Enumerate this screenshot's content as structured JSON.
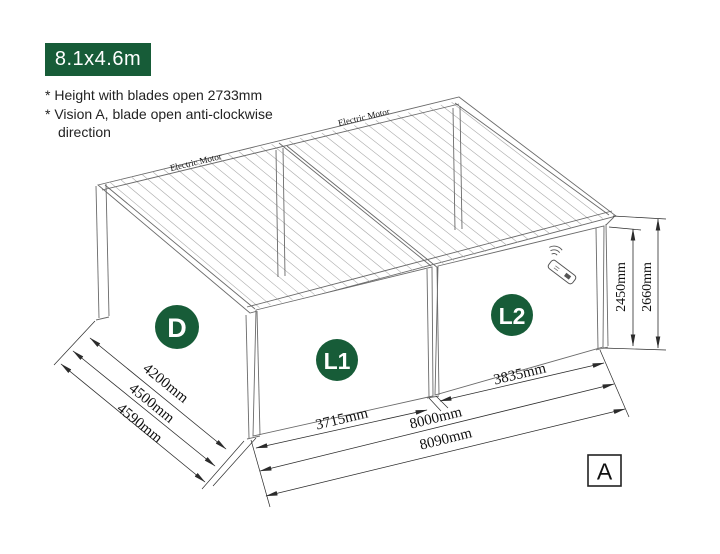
{
  "header": {
    "size_badge": "8.1x4.6m",
    "notes": [
      "* Height with blades open 2733mm",
      "* Vision A, blade open anti-clockwise direction"
    ]
  },
  "diagram": {
    "motor_label_left": "Electric Motor",
    "motor_label_right": "Electric Motor",
    "badges": {
      "depth": "D",
      "bay1": "L1",
      "bay2": "L2"
    },
    "view_label": "A",
    "dimensions": {
      "depth_inner": "4200mm",
      "depth_frame": "4500mm",
      "depth_overall": "4590mm",
      "bay1_width": "3715mm",
      "bay2_width": "3835mm",
      "span_posts": "8000mm",
      "span_overall": "8090mm",
      "height_clear": "2450mm",
      "height_overall": "2660mm"
    },
    "colors": {
      "badge_green": "#175c38",
      "line": "#6a6a6a",
      "dim_line": "#2b2b2b"
    }
  }
}
